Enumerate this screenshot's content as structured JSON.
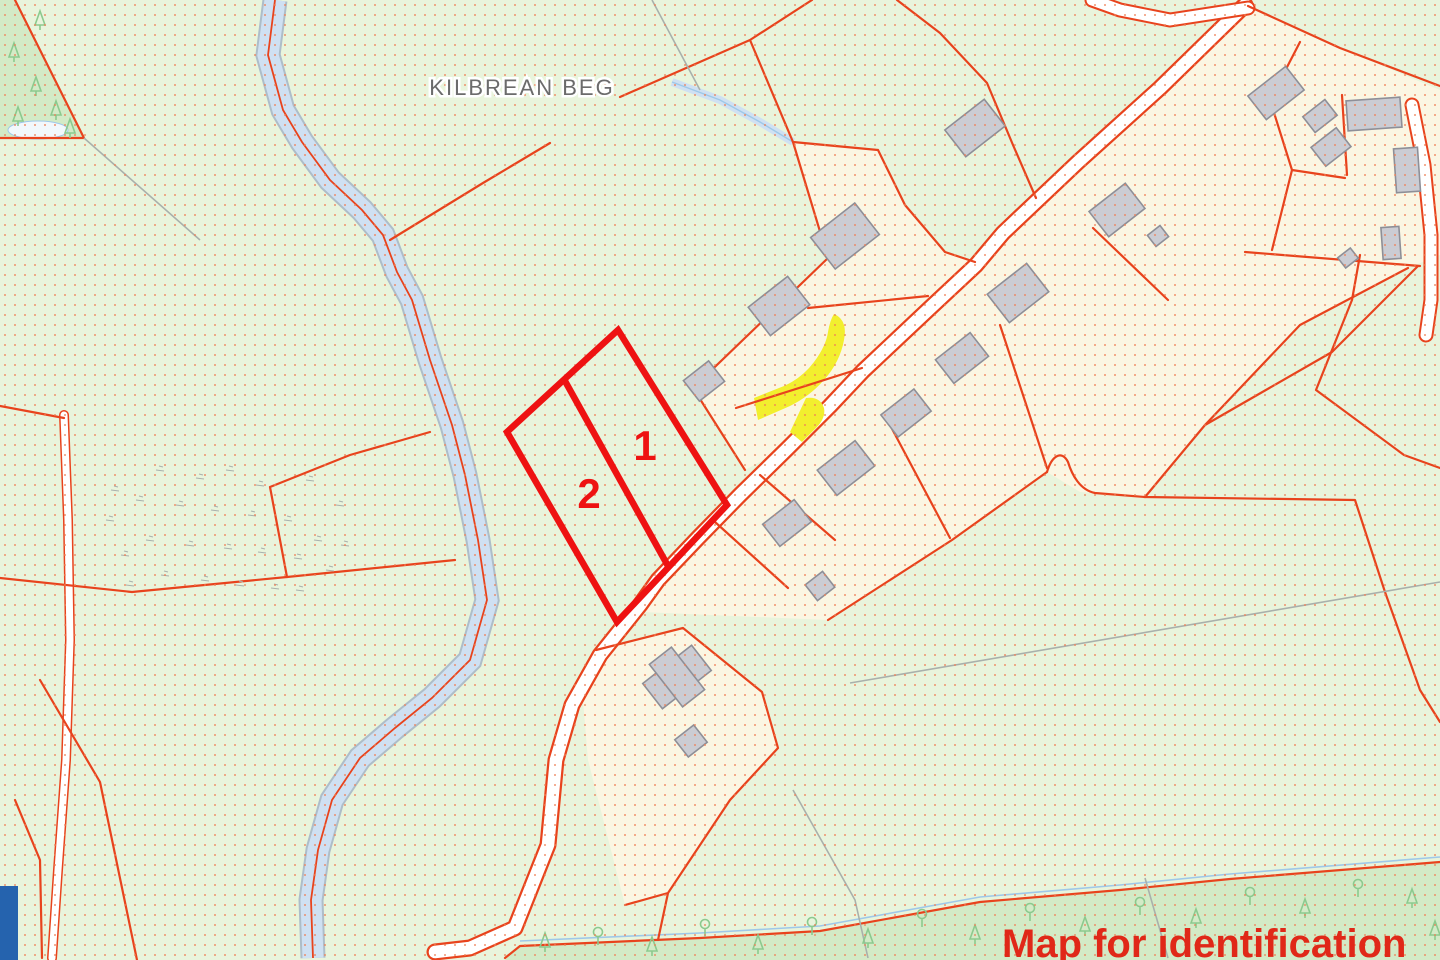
{
  "map": {
    "townland_label": "KILBREAN BEG",
    "plots": {
      "plot1_label": "1",
      "plot2_label": "2"
    },
    "watermark": "Map for identification",
    "icons": {
      "conifer_tree": "conifer-tree-icon",
      "deciduous_tree": "deciduous-tree-icon"
    },
    "colors": {
      "background_green": "#e9f4dc",
      "parcel_cream": "#fbf6e3",
      "forest_green": "#d3eac6",
      "tree_green": "#8cc98e",
      "water_blue": "#cfe0f2",
      "water_edge_gray": "#aebdc8",
      "stream_blue": "#9fc8e8",
      "road_white": "#ffffff",
      "boundary_red": "#e8431d",
      "plot_highlight_red": "#ee1212",
      "dot_orange": "#ef8055",
      "building_gray": "#cbccd3",
      "building_outline_gray": "#8e8f97",
      "yellow_highlight": "#f2ef2e",
      "townland_label_gray": "#6b6b6b",
      "watermark_red": "#e02818",
      "corner_block_blue": "#2563ae",
      "survey_line_gray": "#a9b0ab"
    }
  }
}
